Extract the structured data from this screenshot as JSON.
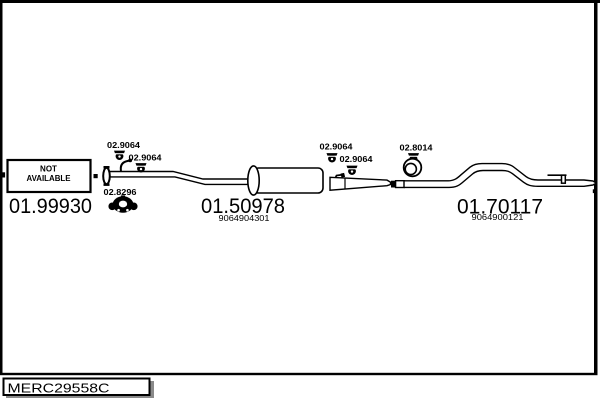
{
  "colors": {
    "ink": "#000000",
    "paper": "#ffffff",
    "shadow": "#8a8a8a"
  },
  "footer": {
    "diagram_code": "MERC29558C"
  },
  "not_available_box": {
    "line1": "NOT",
    "line2": "AVAILABLE"
  },
  "sections": [
    {
      "name": "front pipe",
      "part_number": "01.99930",
      "labels": [
        "02.9064",
        "02.9064",
        "02.8296"
      ]
    },
    {
      "name": "middle silencer",
      "part_number": "01.50978",
      "oem_number": "9064904301",
      "labels": [
        "02.9064",
        "02.9064"
      ]
    },
    {
      "name": "tail pipe",
      "part_number": "01.70117",
      "oem_number": "9064900121",
      "labels": [
        "02.8014"
      ]
    }
  ]
}
